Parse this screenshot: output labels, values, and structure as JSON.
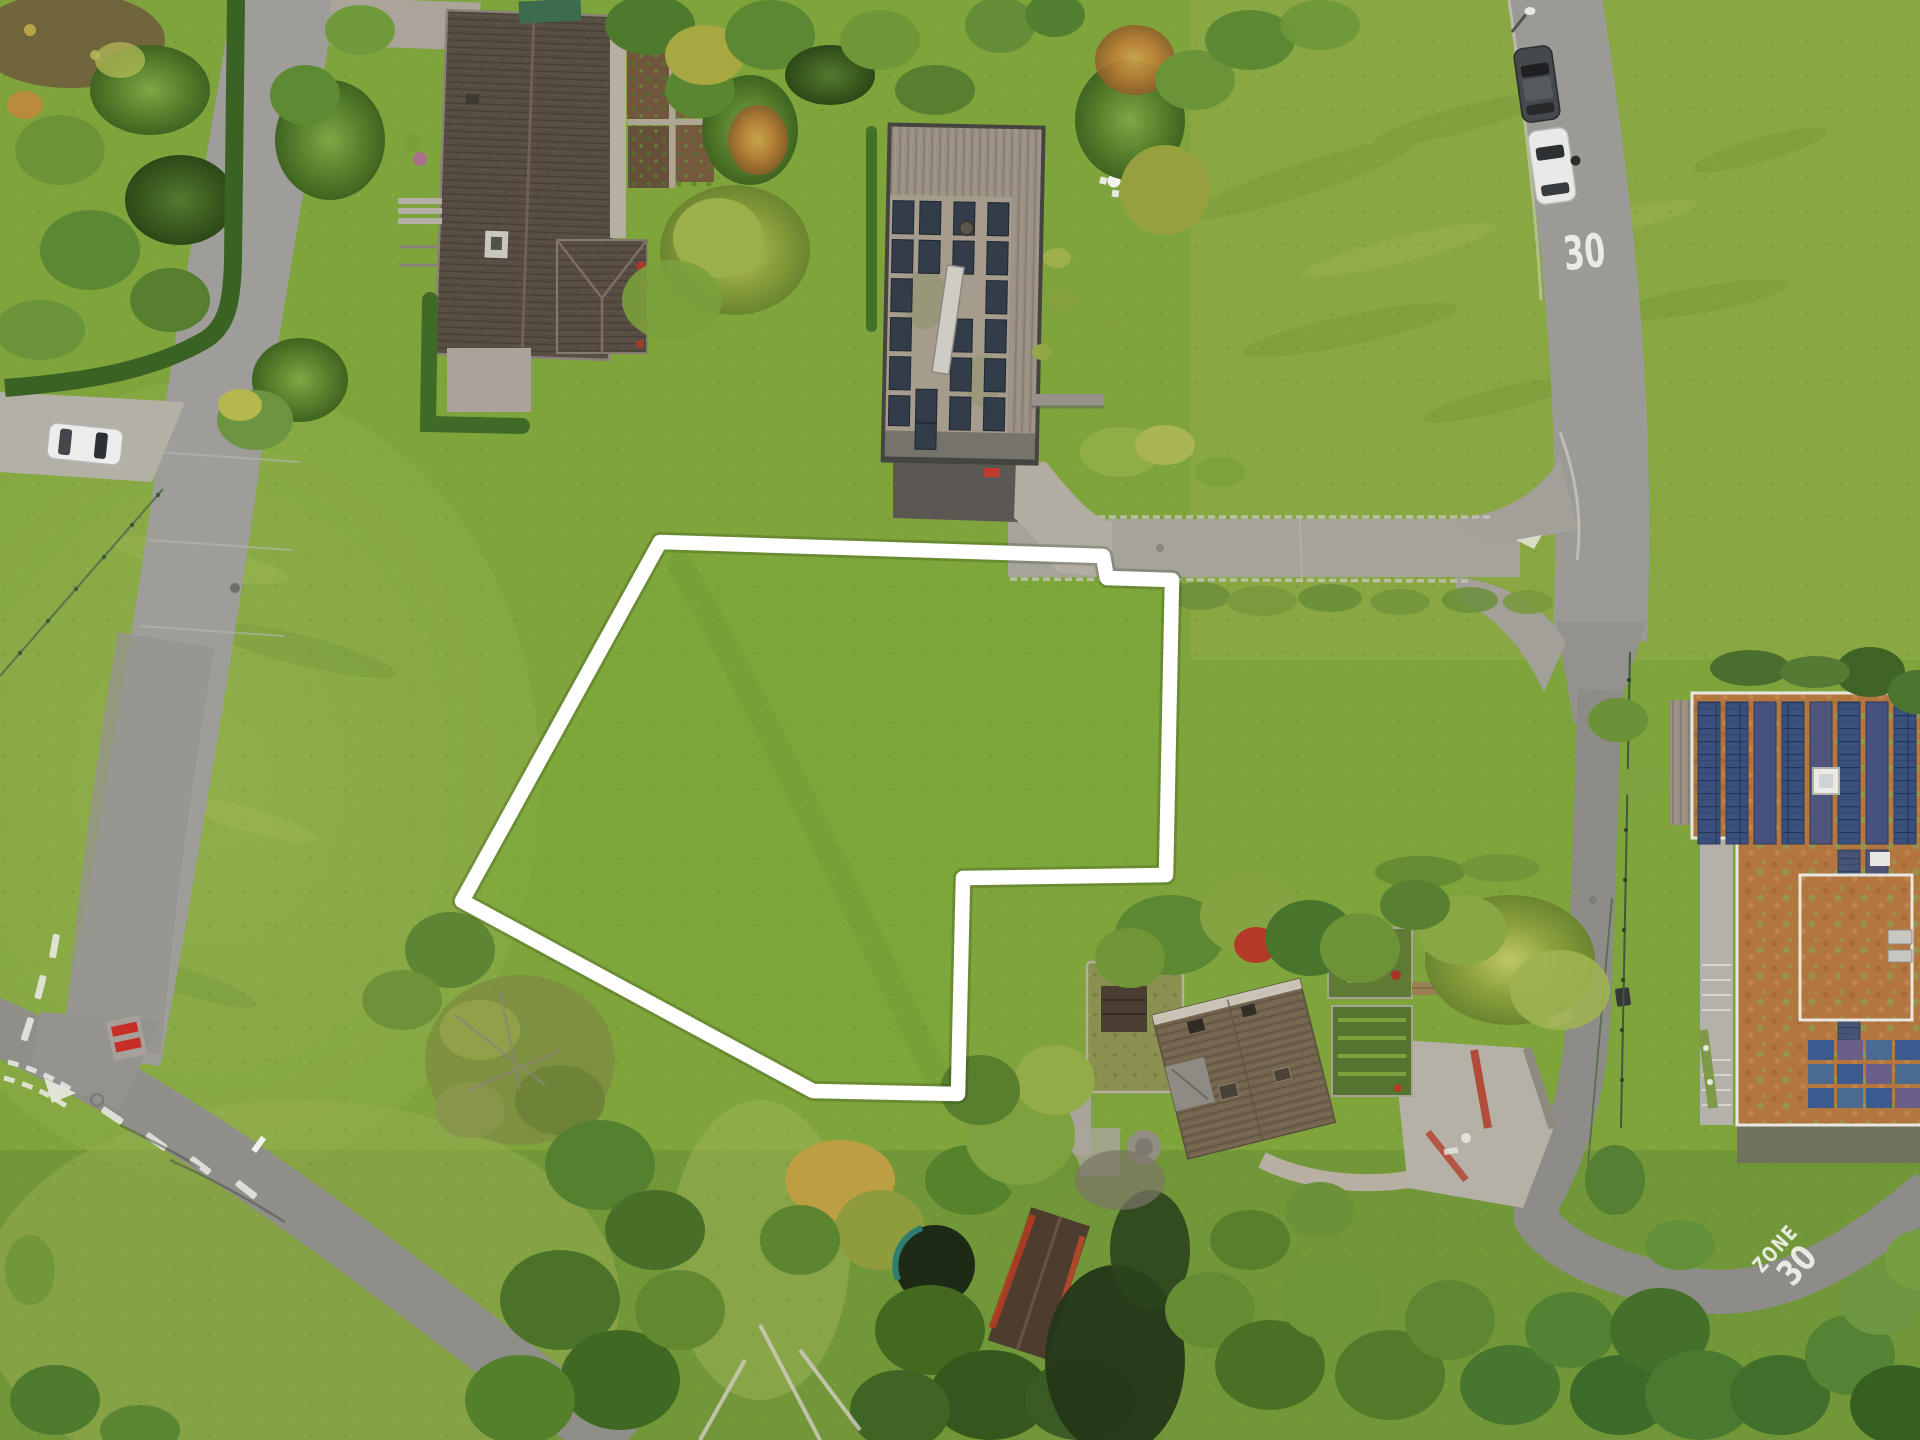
{
  "scene": {
    "kind": "aerial-drone-photograph",
    "subject": "building plot outlined in white between houses, meadows and streets"
  },
  "road_markings": {
    "speed_limit": "30",
    "zone_word": "ZONE",
    "zone_number": "30"
  },
  "colors": {
    "plot_outline": "#ffffff",
    "grass_base": "#7fa43c",
    "meadow_light": "#9ab257",
    "road_gray": "#9b9a96",
    "road_dark": "#8d8c88",
    "solar_panel_blue": "#3a517e",
    "solar_panel_dark": "#333c49",
    "sedum_roof_orange": "#b4763f",
    "old_roof_brown": "#574c42",
    "marking_white": "#f2f1ec",
    "bench_red": "#c62f28",
    "tarp_green": "#3c6b4e"
  }
}
